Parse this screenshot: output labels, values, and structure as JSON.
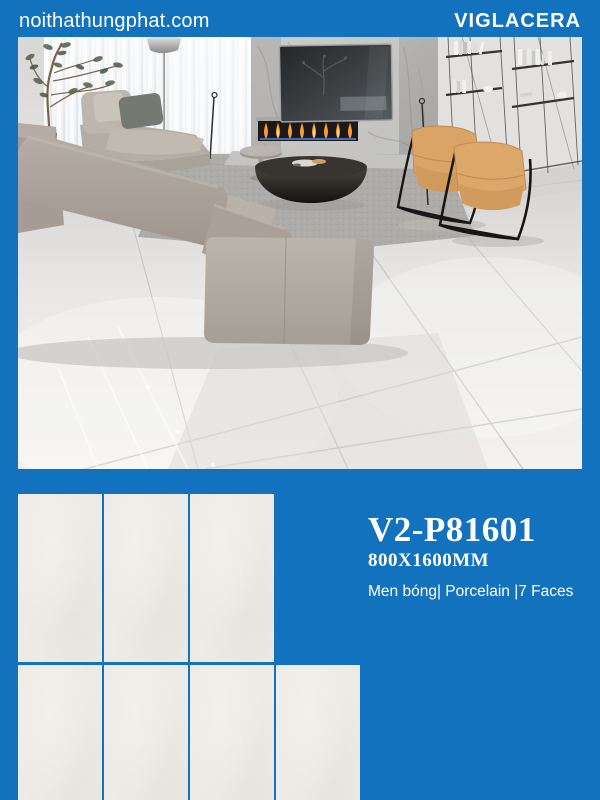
{
  "header": {
    "site": "noithathungphat.com",
    "brand": "VIGLACERA"
  },
  "product": {
    "code": "V2-P81601",
    "size": "800X1600MM",
    "specs": "Men bóng| Porcelain |7 Faces"
  },
  "tile_pattern": {
    "rows": [
      3,
      4
    ]
  },
  "colors": {
    "brand_blue": "#1272BE",
    "tile_white": "#EDEBE5",
    "chair_tan": "#D8A065",
    "sofa_taupe": "#ABA39A"
  }
}
